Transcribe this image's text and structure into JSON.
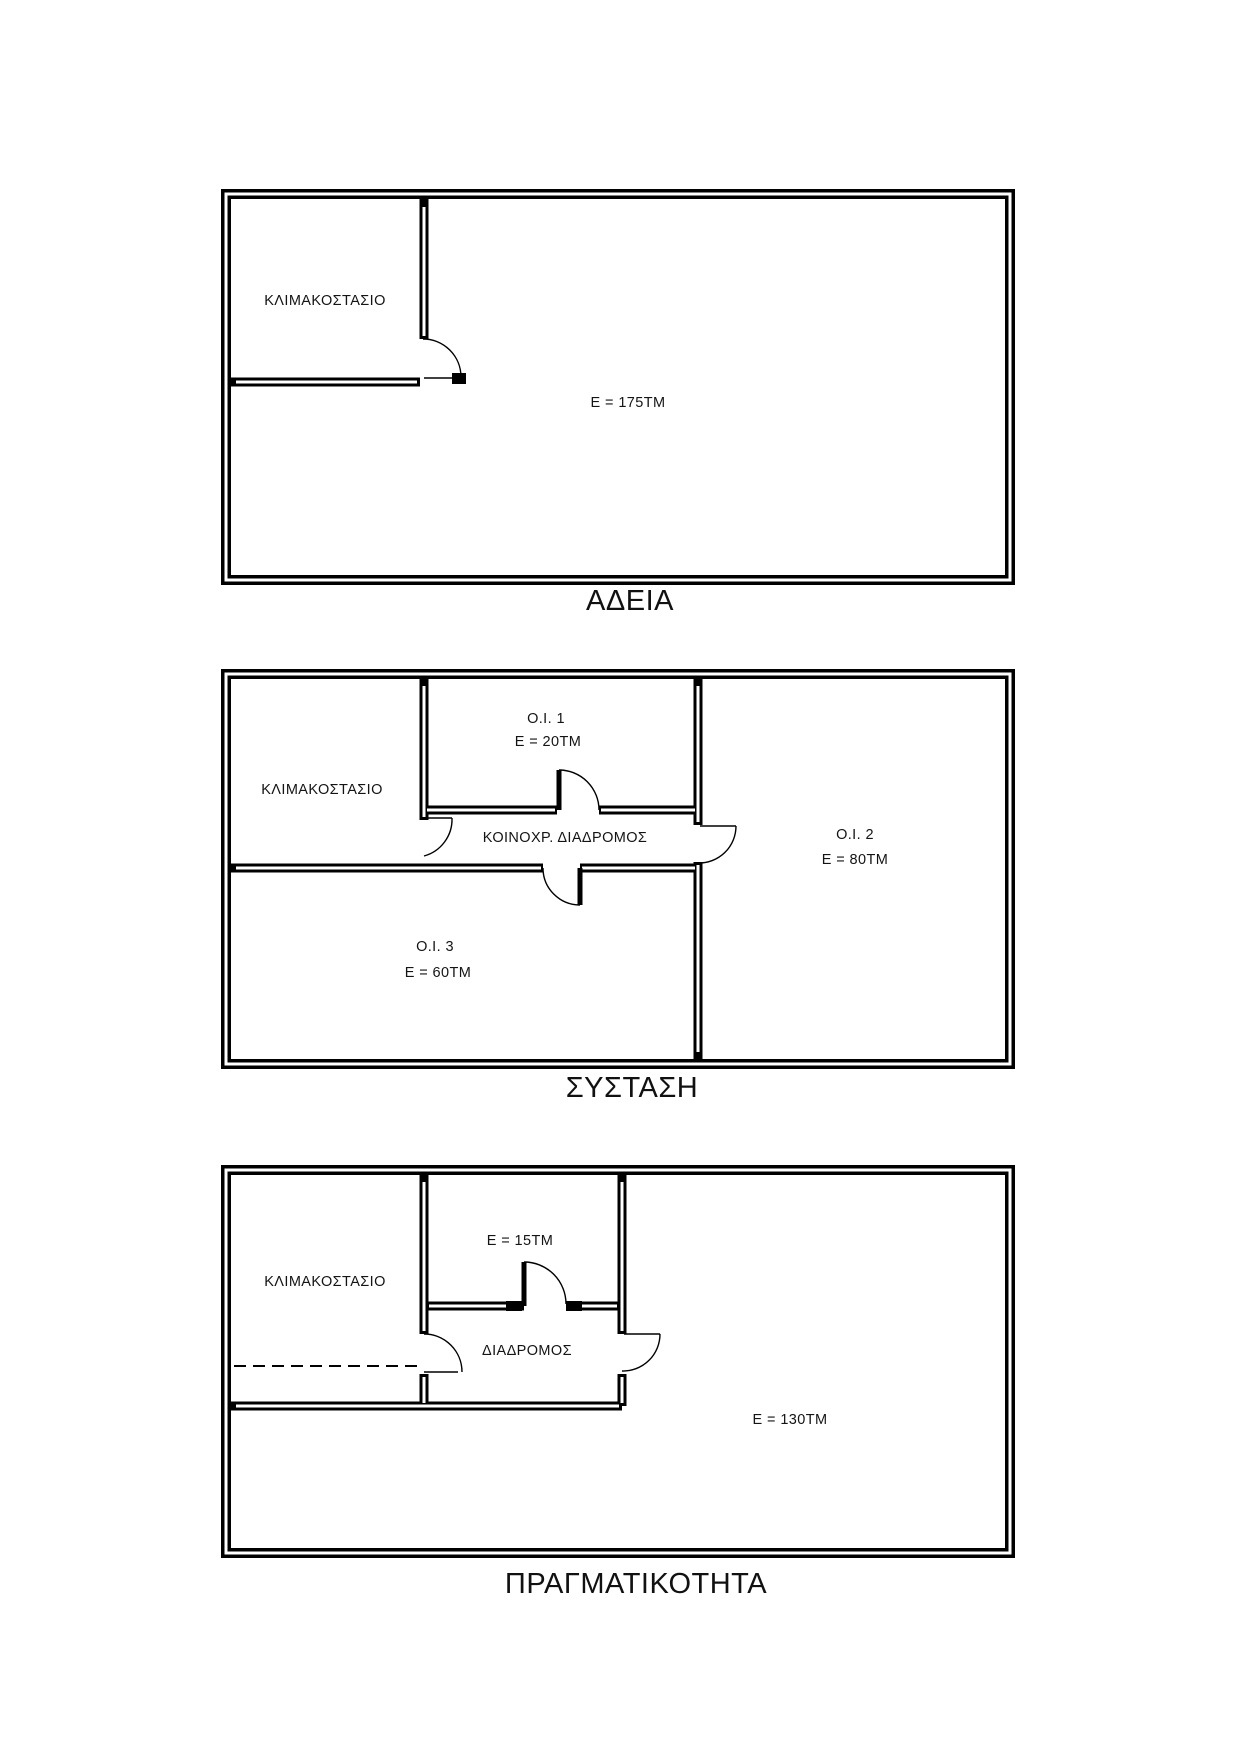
{
  "document": {
    "background": "#ffffff",
    "line_color": "#000000",
    "text_color": "#141414",
    "description": "Three stacked floor-plan diagrams comparing permit, constitution and reality states of a storey"
  },
  "plans": [
    {
      "id": "adeia",
      "title": "ΑΔΕΙΑ",
      "labels": {
        "stairwell": "ΚΛΙΜΑΚΟΣΤΑΣΙΟ",
        "main_area": "E = 175TM"
      }
    },
    {
      "id": "systasi",
      "title": "ΣΥΣΤΑΣΗ",
      "labels": {
        "stairwell": "ΚΛΙΜΑΚΟΣΤΑΣΙΟ",
        "unit1": "O.I. 1",
        "unit1_area": "E = 20TM",
        "corridor": "ΚΟΙΝΟΧΡ. ΔΙΑΔΡΟΜΟΣ",
        "unit2": "O.I. 2",
        "unit2_area": "E = 80TM",
        "unit3": "O.I. 3",
        "unit3_area": "E = 60TM"
      }
    },
    {
      "id": "pragmatikotita",
      "title": "ΠΡΑΓΜΑΤΙΚΟΤΗΤΑ",
      "labels": {
        "stairwell": "ΚΛΙΜΑΚΟΣΤΑΣΙΟ",
        "small_room_area": "E = 15TM",
        "corridor": "ΔΙΑΔΡΟΜΟΣ",
        "main_area": "E = 130TM"
      }
    }
  ]
}
